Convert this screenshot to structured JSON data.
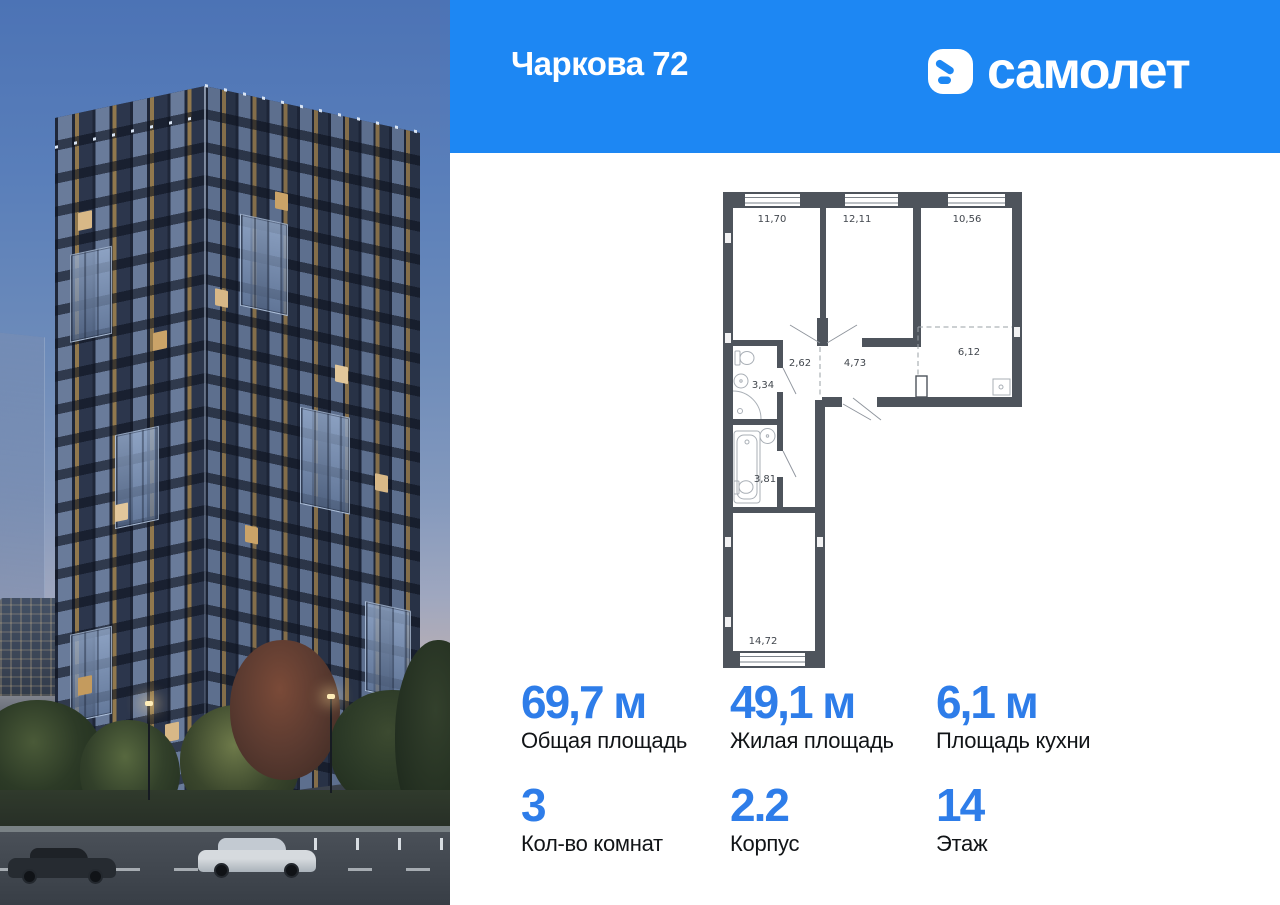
{
  "header": {
    "title": "Чаркова 72",
    "logo_text": "самолет",
    "bg_color": "#1d87f3"
  },
  "colors": {
    "accent_blue": "#2e7de9",
    "plan_wall": "#4e545c"
  },
  "floorplan": {
    "areas": {
      "room1": "11,70",
      "room2": "12,11",
      "room3": "10,56",
      "hall": "2,62",
      "corridor": "4,73",
      "kitchen": "6,12",
      "wc": "3,34",
      "bath": "3,81",
      "living": "14,72"
    }
  },
  "stats": {
    "cells": [
      {
        "value": "69,7 м",
        "label": "Общая площадь"
      },
      {
        "value": "49,1 м",
        "label": "Жилая площадь"
      },
      {
        "value": "6,1 м",
        "label": "Площадь кухни"
      },
      {
        "value": "3",
        "label": "Кол-во комнат"
      },
      {
        "value": "2.2",
        "label": "Корпус"
      },
      {
        "value": "14",
        "label": "Этаж"
      }
    ]
  }
}
